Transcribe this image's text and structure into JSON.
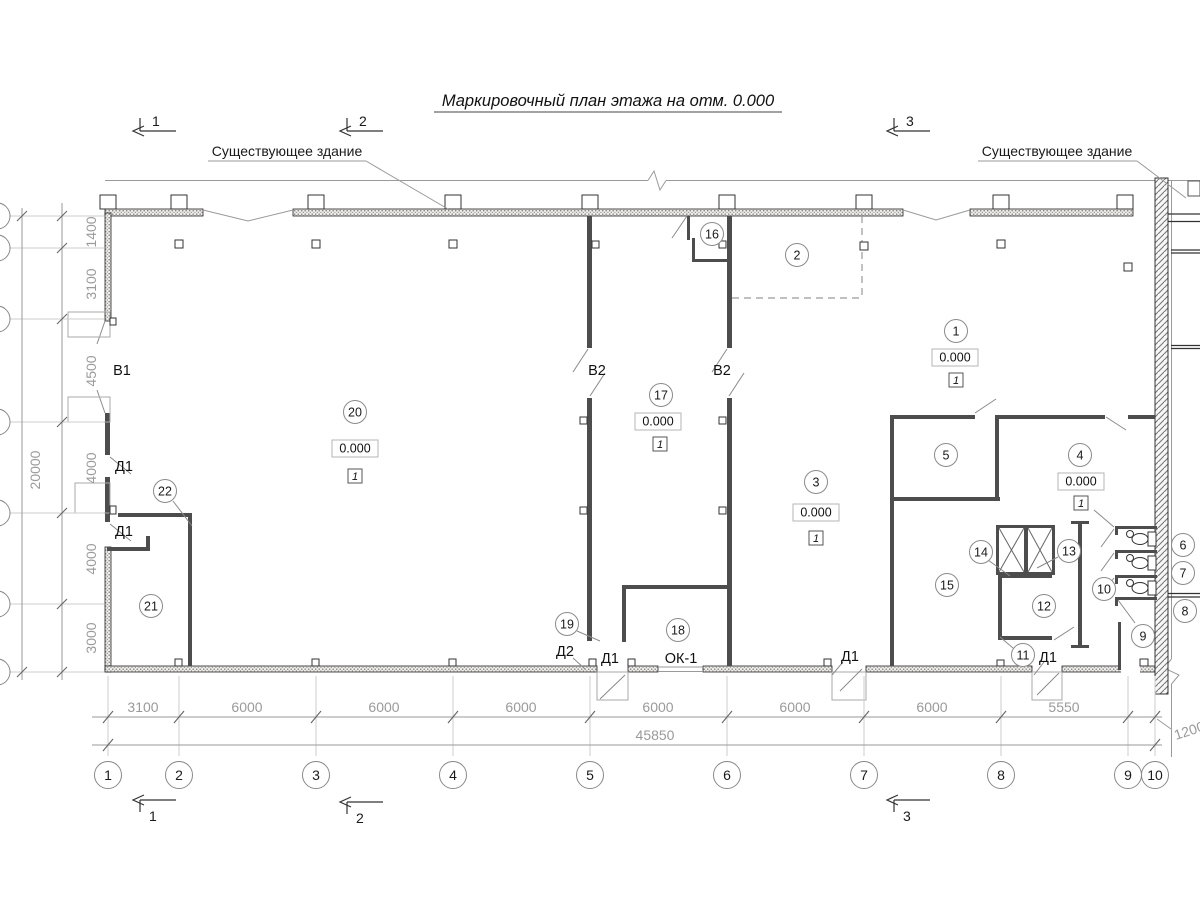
{
  "title": "Маркировочный план этажа на отм. 0.000",
  "annotations": {
    "existing_left": "Существующее здание",
    "existing_right": "Существующее здание"
  },
  "sections": {
    "s1": "1",
    "s2": "2",
    "s3": "3"
  },
  "grid": {
    "cols": [
      "1",
      "2",
      "3",
      "4",
      "5",
      "6",
      "7",
      "8",
      "9",
      "10"
    ]
  },
  "dims": {
    "bottom": [
      "3100",
      "6000",
      "6000",
      "6000",
      "6000",
      "6000",
      "6000",
      "5550"
    ],
    "bottom_small": "1200",
    "bottom_total": "45850",
    "left": [
      "1400",
      "3100",
      "4500",
      "4000",
      "4000",
      "3000"
    ],
    "left_total": "20000"
  },
  "rooms": {
    "r1": "1",
    "r2": "2",
    "r3": "3",
    "r4": "4",
    "r5": "5",
    "r6": "6",
    "r7": "7",
    "r8": "8",
    "r9": "9",
    "r10": "10",
    "r11": "11",
    "r12": "12",
    "r13": "13",
    "r14": "14",
    "r15": "15",
    "r16": "16",
    "r17": "17",
    "r18": "18",
    "r19": "19",
    "r20": "20",
    "r21": "21",
    "r22": "22"
  },
  "elevations": {
    "value": "0.000",
    "mark": "1"
  },
  "openings": {
    "v1": "В1",
    "v2a": "В2",
    "v2b": "В2",
    "d1a": "Д1",
    "d1b": "Д1",
    "d1c": "Д1",
    "d1d": "Д1",
    "d1e": "Д1",
    "d2": "Д2",
    "ok1": "ОК-1"
  }
}
